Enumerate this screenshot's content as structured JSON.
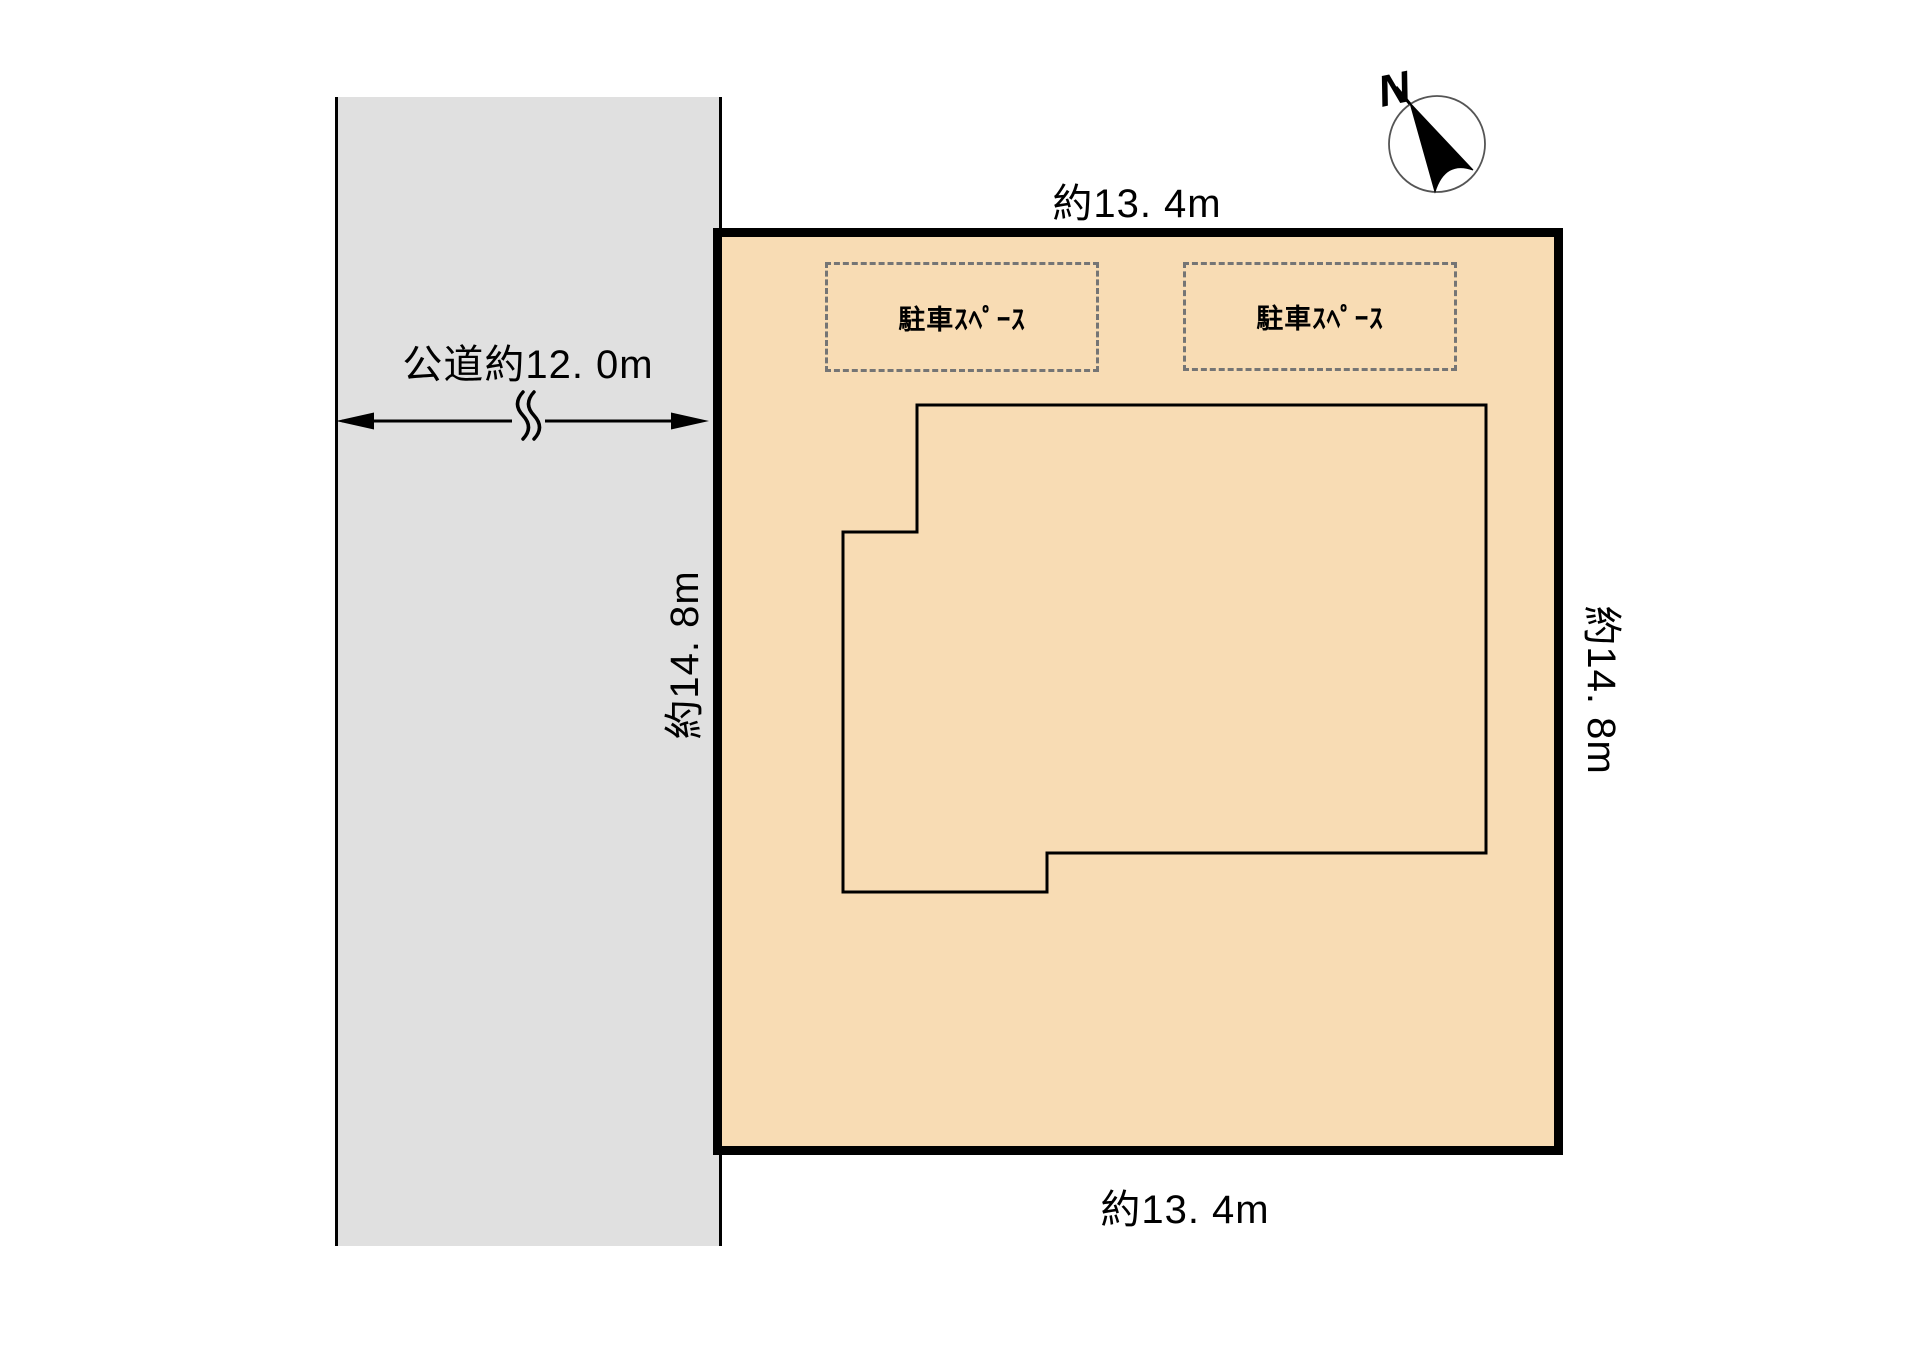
{
  "colors": {
    "land_fill": "#f8dcb4",
    "road_fill": "#e0e0e0",
    "line": "#000000",
    "dash": "#757575",
    "compass_ring": "#555555"
  },
  "road": {
    "label": "公道約12. 0m"
  },
  "dimensions": {
    "top": "約13. 4m",
    "bottom": "約13. 4m",
    "left": "約14. 8m",
    "right": "約14. 8m"
  },
  "parking": {
    "spaces": [
      {
        "label": "駐車ｽﾍﾟｰｽ"
      },
      {
        "label": "駐車ｽﾍﾟｰｽ"
      }
    ]
  },
  "compass": {
    "label": "N"
  }
}
